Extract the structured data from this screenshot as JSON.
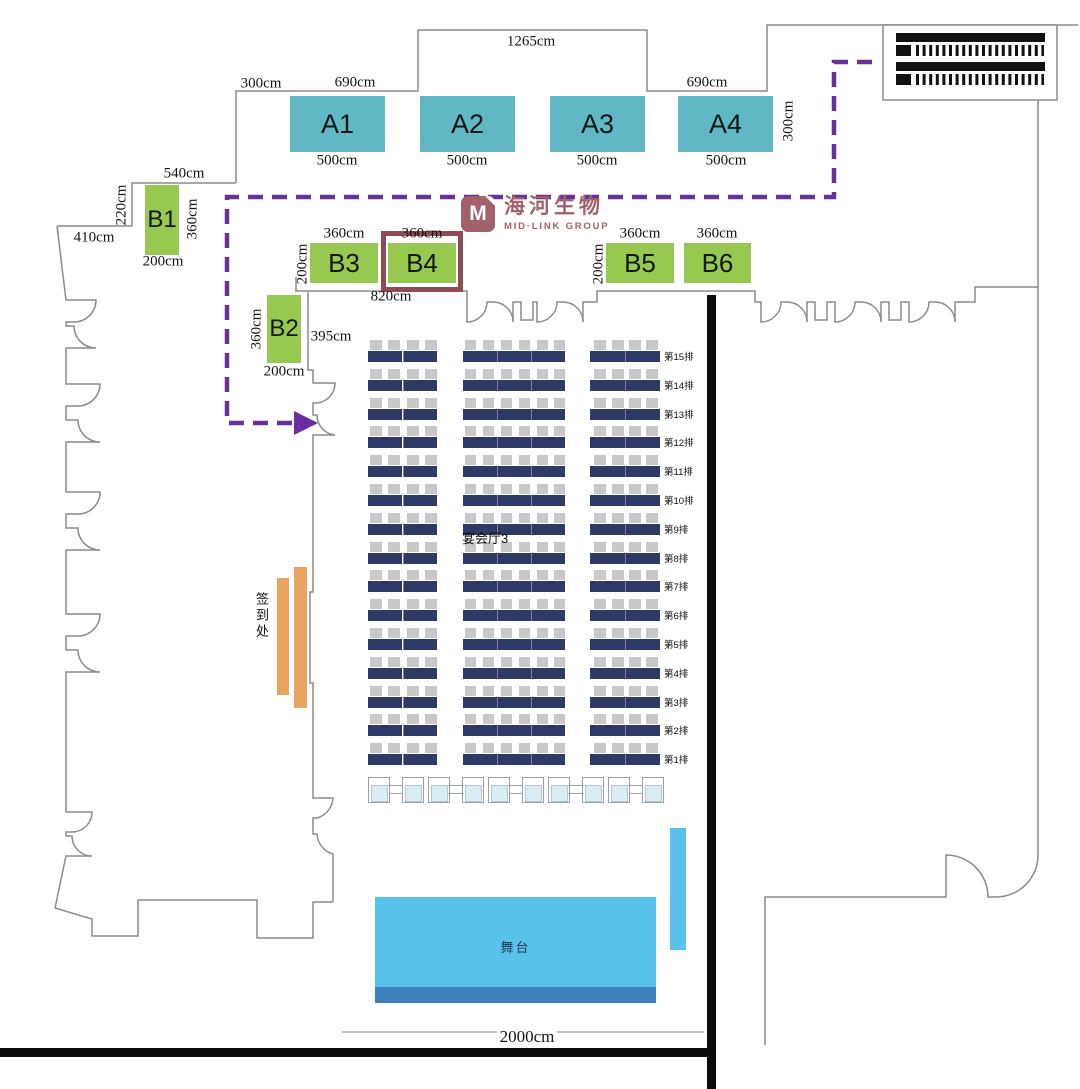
{
  "colors": {
    "wall": "#8c8c8c",
    "route": "#6b2e9e",
    "boothTeal": "#5fb8c3",
    "boothGreen": "#97c84f",
    "highlight": "#8d4b55",
    "logoCol": "#a2606b",
    "tableNavy": "#2e3a66",
    "tableDivider": "#8d7ba6",
    "chair": "#c8c8c8",
    "orange": "#e7a55f",
    "stageBlue": "#58c2ea",
    "stageEdge": "#3e7fbe",
    "vipFill": "#d9edf5",
    "vipBorder": "#9aa0a6",
    "barBlack": "#0b0b0b"
  },
  "logo": {
    "mark": "M",
    "nameCn": "海河生物",
    "nameEn": "MID·LINK GROUP"
  },
  "booths": {
    "a": [
      {
        "id": "A1",
        "size": "500cm"
      },
      {
        "id": "A2",
        "size": "500cm"
      },
      {
        "id": "A3",
        "size": "500cm"
      },
      {
        "id": "A4",
        "size": "500cm"
      }
    ],
    "b": [
      {
        "id": "B1"
      },
      {
        "id": "B2"
      },
      {
        "id": "B3"
      },
      {
        "id": "B4",
        "highlighted": true
      },
      {
        "id": "B5"
      },
      {
        "id": "B6"
      }
    ]
  },
  "dims": {
    "alcove": "1265cm",
    "aLeft": "300cm",
    "aSpan1": "690cm",
    "aSpan2": "690cm",
    "aRight": "300cm",
    "b1Top": "540cm",
    "b1Side": "220cm",
    "outerWall": "410cm",
    "b1H": "360cm",
    "b1W": "200cm",
    "b2H": "360cm",
    "b2W": "200cm",
    "b2Wall": "395cm",
    "b3Top": "360cm",
    "b3Side": "200cm",
    "b4Top": "360cm",
    "b5Top": "360cm",
    "b5Side": "200cm",
    "b6Top": "360cm",
    "b34Wall": "820cm",
    "hallWidth": "2000cm"
  },
  "seating": {
    "hallLabel": "宴会厅3",
    "rows": [
      "第15排",
      "第14排",
      "第13排",
      "第12排",
      "第11排",
      "第10排",
      "第9排",
      "第8排",
      "第7排",
      "第6排",
      "第5排",
      "第4排",
      "第3排",
      "第2排",
      "第1排"
    ]
  },
  "receptionDesk": {
    "label": "签到处"
  },
  "stage": {
    "label": "舞台"
  },
  "receptionTables": {
    "pairs": 5
  }
}
